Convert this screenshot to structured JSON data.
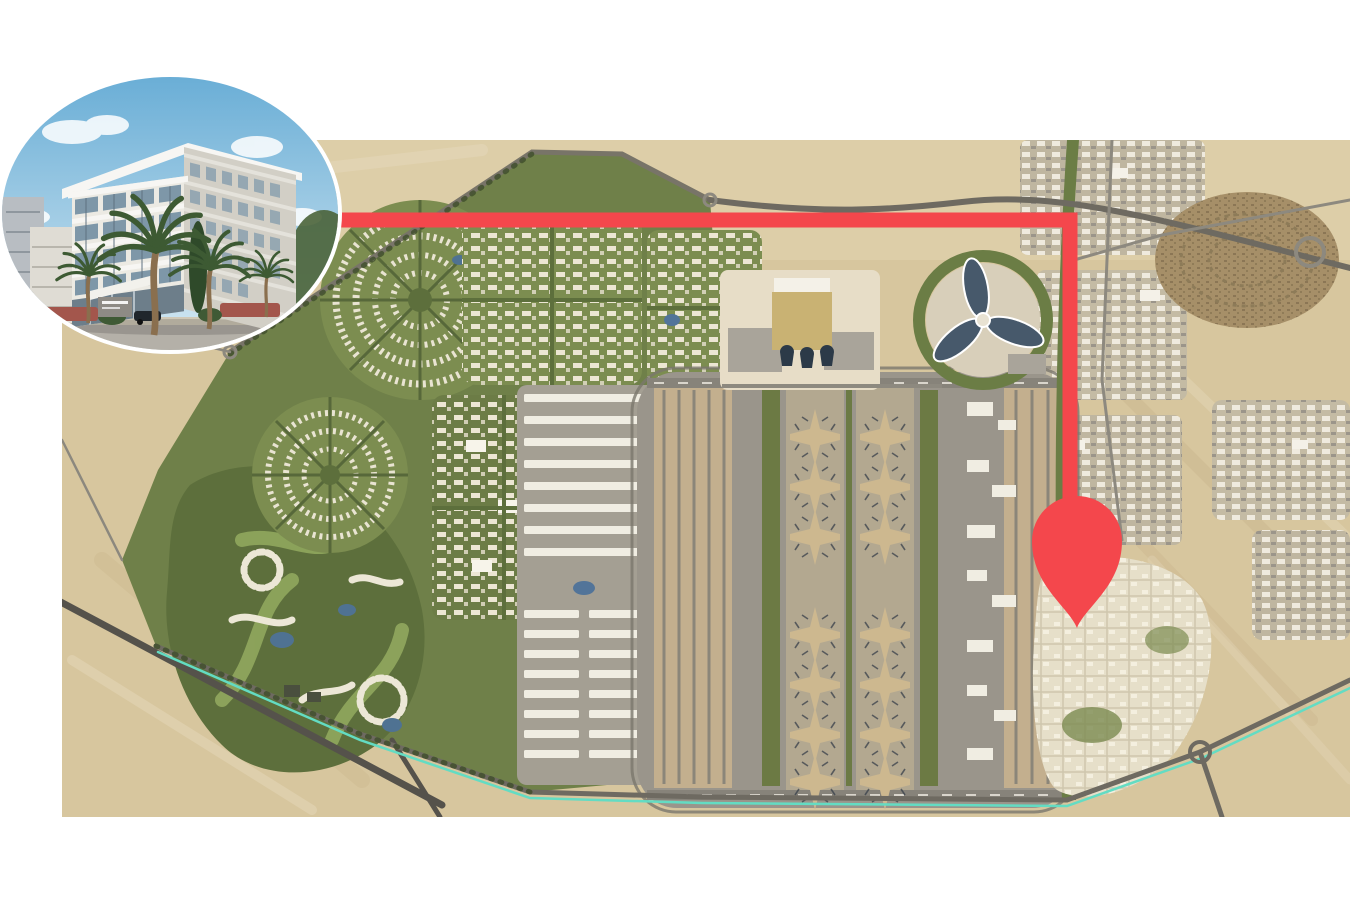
{
  "scene": {
    "background": "#ffffff",
    "kind": "property-location-marketing-map"
  },
  "map": {
    "semantic": "aerial-masterplan-map",
    "palette": {
      "sand": "#d7c69e",
      "sand_light": "#e5d7b4",
      "sand_dark": "#c3ae85",
      "dev_green": "#6f8049",
      "green_dark": "#57683a",
      "green_light": "#93a75e",
      "district_white": "#ece6d3",
      "apron_grey": "#9a958b",
      "apron_light": "#aaa59b",
      "runway_tan": "#c3af8e",
      "runway_dark": "#87837a",
      "road_grey": "#6e6a61",
      "road_light": "#8d897f",
      "water_blue": "#527499",
      "metro_teal": "#63dcc3",
      "terminal_gold": "#c9b273",
      "plaza_cream": "#e7ddc7",
      "expo_petal": "#47596b",
      "expo_plaza": "#d8cfba",
      "urban_base": "#bfb6a0",
      "urban_brown": "#a68f68",
      "concourse_tan": "#cdb88f",
      "aircraft_dark": "#39414b",
      "warehouse_white": "#f0ede2",
      "warehouse_grey": "#a49f93"
    }
  },
  "route": {
    "semantic": "route-connector-line",
    "color": "#f4474c",
    "thickness": 15
  },
  "pin": {
    "semantic": "location-pin-icon",
    "color": "#f4474c"
  },
  "inset": {
    "semantic": "property-building-photo",
    "palette": {
      "sky_top": "#6aaed6",
      "sky_low": "#d6e9f3",
      "cloud": "#ffffff",
      "facade": "#eceae3",
      "facade_side": "#d2cfc6",
      "slab": "#f7f6f3",
      "glass": "#7e97a8",
      "glass_dark": "#5f7180",
      "palm_green": "#3d5a33",
      "trunk_brown": "#8a6f4e",
      "hedge_red": "#a3564c",
      "road": "#b4b0a8",
      "sidewalk": "#d0c9b8"
    }
  }
}
